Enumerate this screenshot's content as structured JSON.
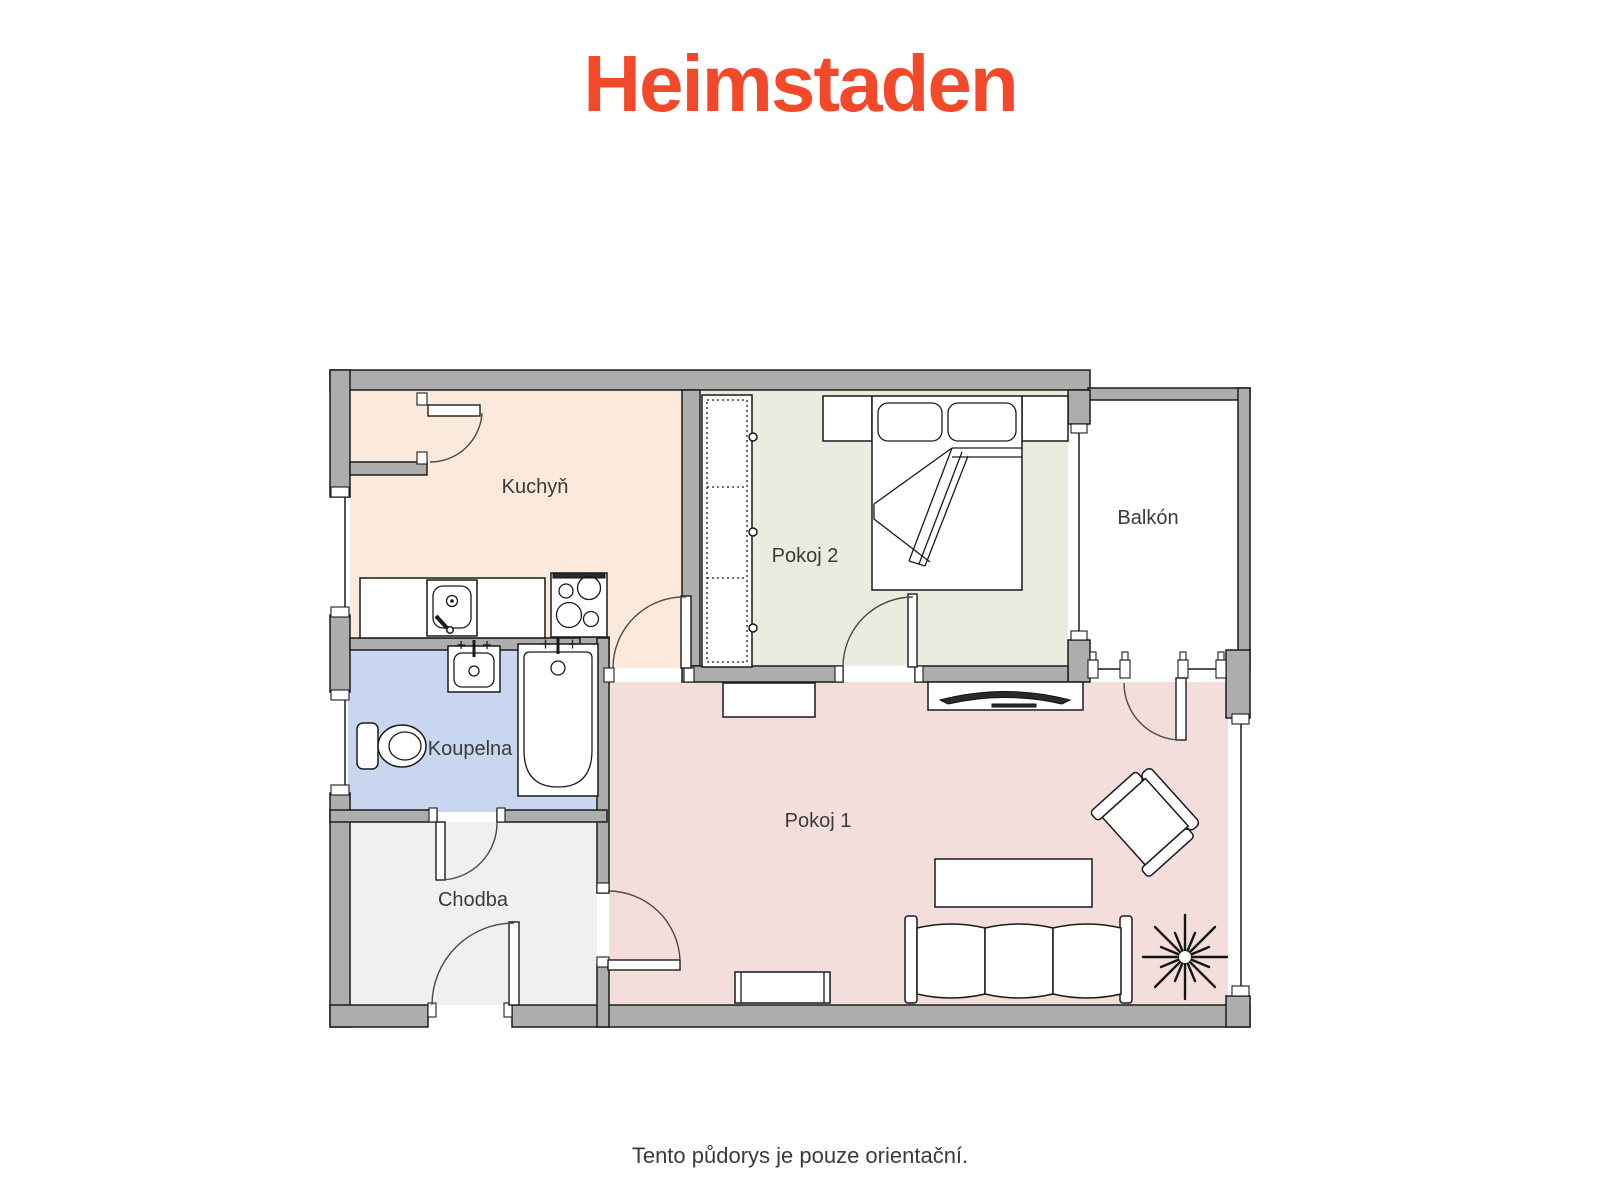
{
  "logo": {
    "text": "Heimstaden",
    "color": "#F1492A"
  },
  "floorplan": {
    "wall_color": "#ADADAD",
    "line_color": "#1C1C1C",
    "label_color": "#3A3A3A",
    "rooms": [
      {
        "id": "kuchyn",
        "label": "Kuchyň",
        "color": "#FBE9DB"
      },
      {
        "id": "pokoj2",
        "label": "Pokoj 2",
        "color": "#E8EDDF"
      },
      {
        "id": "balkon",
        "label": "Balkón",
        "color": "#FFFFFF"
      },
      {
        "id": "koupelna",
        "label": "Koupelna",
        "color": "#C8D7EF"
      },
      {
        "id": "chodba",
        "label": "Chodba",
        "color": "#F0F0F0"
      },
      {
        "id": "pokoj1",
        "label": "Pokoj 1",
        "color": "#F3DEDC"
      }
    ],
    "furniture": [
      {
        "room": "kuchyn",
        "items": [
          "kitchen-counter",
          "kitchen-sink",
          "stove"
        ]
      },
      {
        "room": "pokoj2",
        "items": [
          "wardrobe",
          "double-bed",
          "nightstand-left",
          "nightstand-right"
        ]
      },
      {
        "room": "koupelna",
        "items": [
          "toilet",
          "washbasin",
          "bathtub"
        ]
      },
      {
        "room": "chodba",
        "items": []
      },
      {
        "room": "balkon",
        "items": []
      },
      {
        "room": "pokoj1",
        "items": [
          "sideboard",
          "tv",
          "tv-stand",
          "coffee-table",
          "sofa",
          "armchair",
          "plant",
          "radiator"
        ]
      }
    ]
  },
  "footer": {
    "note": "Tento půdorys je pouze orientační."
  }
}
